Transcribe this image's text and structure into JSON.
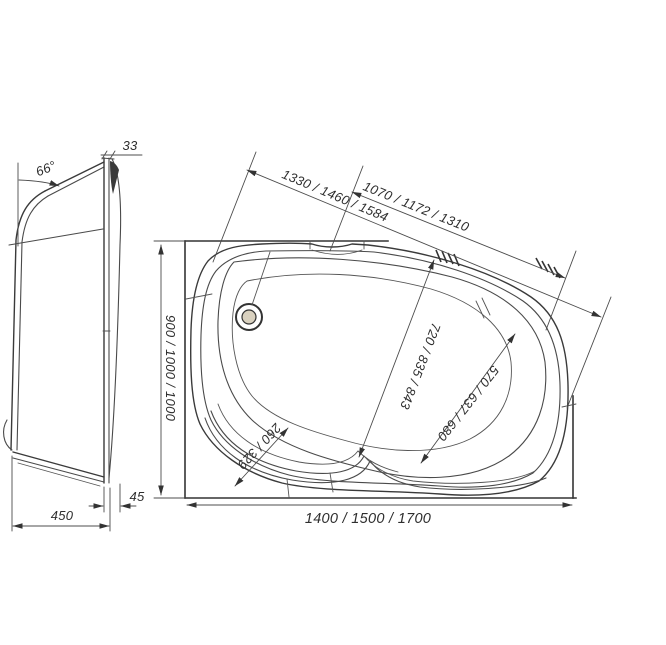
{
  "page": {
    "background": "#ffffff",
    "line_color": "#3a3a3a"
  },
  "side_view": {
    "angle_label": "66°",
    "rim_overhang": "33",
    "skirt_inset": "45",
    "overall_depth": "450"
  },
  "top_view": {
    "diagonal_outer": "1330 / 1460 / 1584",
    "diagonal_inner": "1070 / 1172 / 1310",
    "overall_width": "900 / 1000 / 1000",
    "overall_length": "1400 / 1500 / 1700",
    "bowl_length": "720 / 835 / 843",
    "bowl_width": "570 / 637 / 680",
    "seat_width": "260 / 329"
  }
}
